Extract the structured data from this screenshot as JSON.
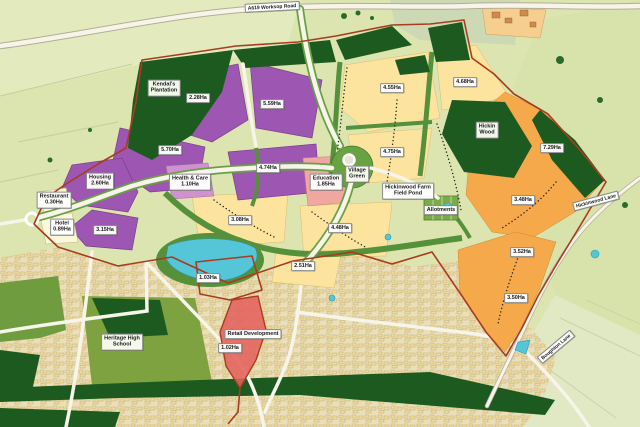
{
  "map": {
    "description": "Land use masterplan map of a garden village extension north-east of an existing town",
    "colors": {
      "field": "#dce4af",
      "purple_parcel": "#9d57b2",
      "yellow_parcel": "#fce49e",
      "orange_parcel": "#f5a94b",
      "education_pink": "#f0a7a0",
      "health_lilac": "#cf92cf",
      "hotel_cream": "#fdf7dc",
      "water_cyan": "#54c6d8",
      "woodland_dark": "#1d5a20",
      "green_belt": "#55903a",
      "village_green": "#68a243",
      "retail_red": "#e2625e",
      "site_boundary_red": "#a83c20",
      "town_building": "#f2da96"
    }
  },
  "labels": [
    {
      "id": "road-a619",
      "text": "A619 Worksop Road",
      "x": 272,
      "y": 7,
      "rot": -3,
      "style": "road"
    },
    {
      "id": "kendals-plantation",
      "text": "Kendal's\nPlantation",
      "x": 164,
      "y": 88,
      "style": "wood"
    },
    {
      "id": "parcel-2-28ha",
      "text": "2.28Ha",
      "x": 198,
      "y": 98
    },
    {
      "id": "parcel-5-59ha",
      "text": "5.59Ha",
      "x": 272,
      "y": 104
    },
    {
      "id": "parcel-5-70ha",
      "text": "5.70Ha",
      "x": 170,
      "y": 150
    },
    {
      "id": "parcel-4-74ha",
      "text": "4.74Ha",
      "x": 268,
      "y": 168
    },
    {
      "id": "parcel-housing-2-60ha",
      "text": "Housing\n2.60Ha",
      "x": 100,
      "y": 181
    },
    {
      "id": "parcel-3-15ha",
      "text": "3.15Ha",
      "x": 105,
      "y": 230
    },
    {
      "id": "parcel-restaurant",
      "text": "Restaurant\n0.30Ha",
      "x": 54,
      "y": 200
    },
    {
      "id": "parcel-hotel",
      "text": "Hotel\n0.89Ha",
      "x": 62,
      "y": 227
    },
    {
      "id": "parcel-health-care",
      "text": "Health & Care\n1.10Ha",
      "x": 190,
      "y": 182
    },
    {
      "id": "parcel-education",
      "text": "Education\n1.85Ha",
      "x": 326,
      "y": 182
    },
    {
      "id": "parcel-4-55ha",
      "text": "4.55Ha",
      "x": 392,
      "y": 88
    },
    {
      "id": "parcel-4-68ha",
      "text": "4.68Ha",
      "x": 465,
      "y": 82
    },
    {
      "id": "hickin-wood",
      "text": "Hickin\nWood",
      "x": 487,
      "y": 130,
      "style": "wood"
    },
    {
      "id": "parcel-7-29ha",
      "text": "7.29Ha",
      "x": 552,
      "y": 148
    },
    {
      "id": "parcel-4-75ha",
      "text": "4.75Ha",
      "x": 392,
      "y": 152
    },
    {
      "id": "village-green",
      "text": "Village\nGreen",
      "x": 357,
      "y": 174,
      "style": "wood"
    },
    {
      "id": "parcel-3-08ha",
      "text": "3.08Ha",
      "x": 240,
      "y": 220
    },
    {
      "id": "parcel-4-48ha",
      "text": "4.48Ha",
      "x": 340,
      "y": 228
    },
    {
      "id": "hickinwood-farm-pond",
      "text": "Hickinwood Farm\nField Pond",
      "x": 408,
      "y": 191
    },
    {
      "id": "allotments",
      "text": "Allotments",
      "x": 441,
      "y": 210
    },
    {
      "id": "parcel-3-48ha",
      "text": "3.48Ha",
      "x": 523,
      "y": 200
    },
    {
      "id": "road-hickinwood-lane",
      "text": "Hickinwood Lane",
      "x": 596,
      "y": 201,
      "rot": -15,
      "style": "road"
    },
    {
      "id": "parcel-2-51ha",
      "text": "2.51Ha",
      "x": 303,
      "y": 266
    },
    {
      "id": "parcel-3-52ha",
      "text": "3.52Ha",
      "x": 522,
      "y": 252
    },
    {
      "id": "parcel-3-50ha",
      "text": "3.50Ha",
      "x": 516,
      "y": 298
    },
    {
      "id": "parcel-1-03ha",
      "text": "1.03Ha",
      "x": 208,
      "y": 278
    },
    {
      "id": "parcel-1-02ha",
      "text": "1.02Ha",
      "x": 230,
      "y": 348
    },
    {
      "id": "retail-development",
      "text": "Retail Development",
      "x": 253,
      "y": 334
    },
    {
      "id": "heritage-high-school",
      "text": "Heritage High\nSchool",
      "x": 122,
      "y": 342,
      "style": "wood"
    },
    {
      "id": "road-boughton-lane",
      "text": "Boughton Lane",
      "x": 556,
      "y": 347,
      "rot": -40,
      "style": "road"
    }
  ]
}
